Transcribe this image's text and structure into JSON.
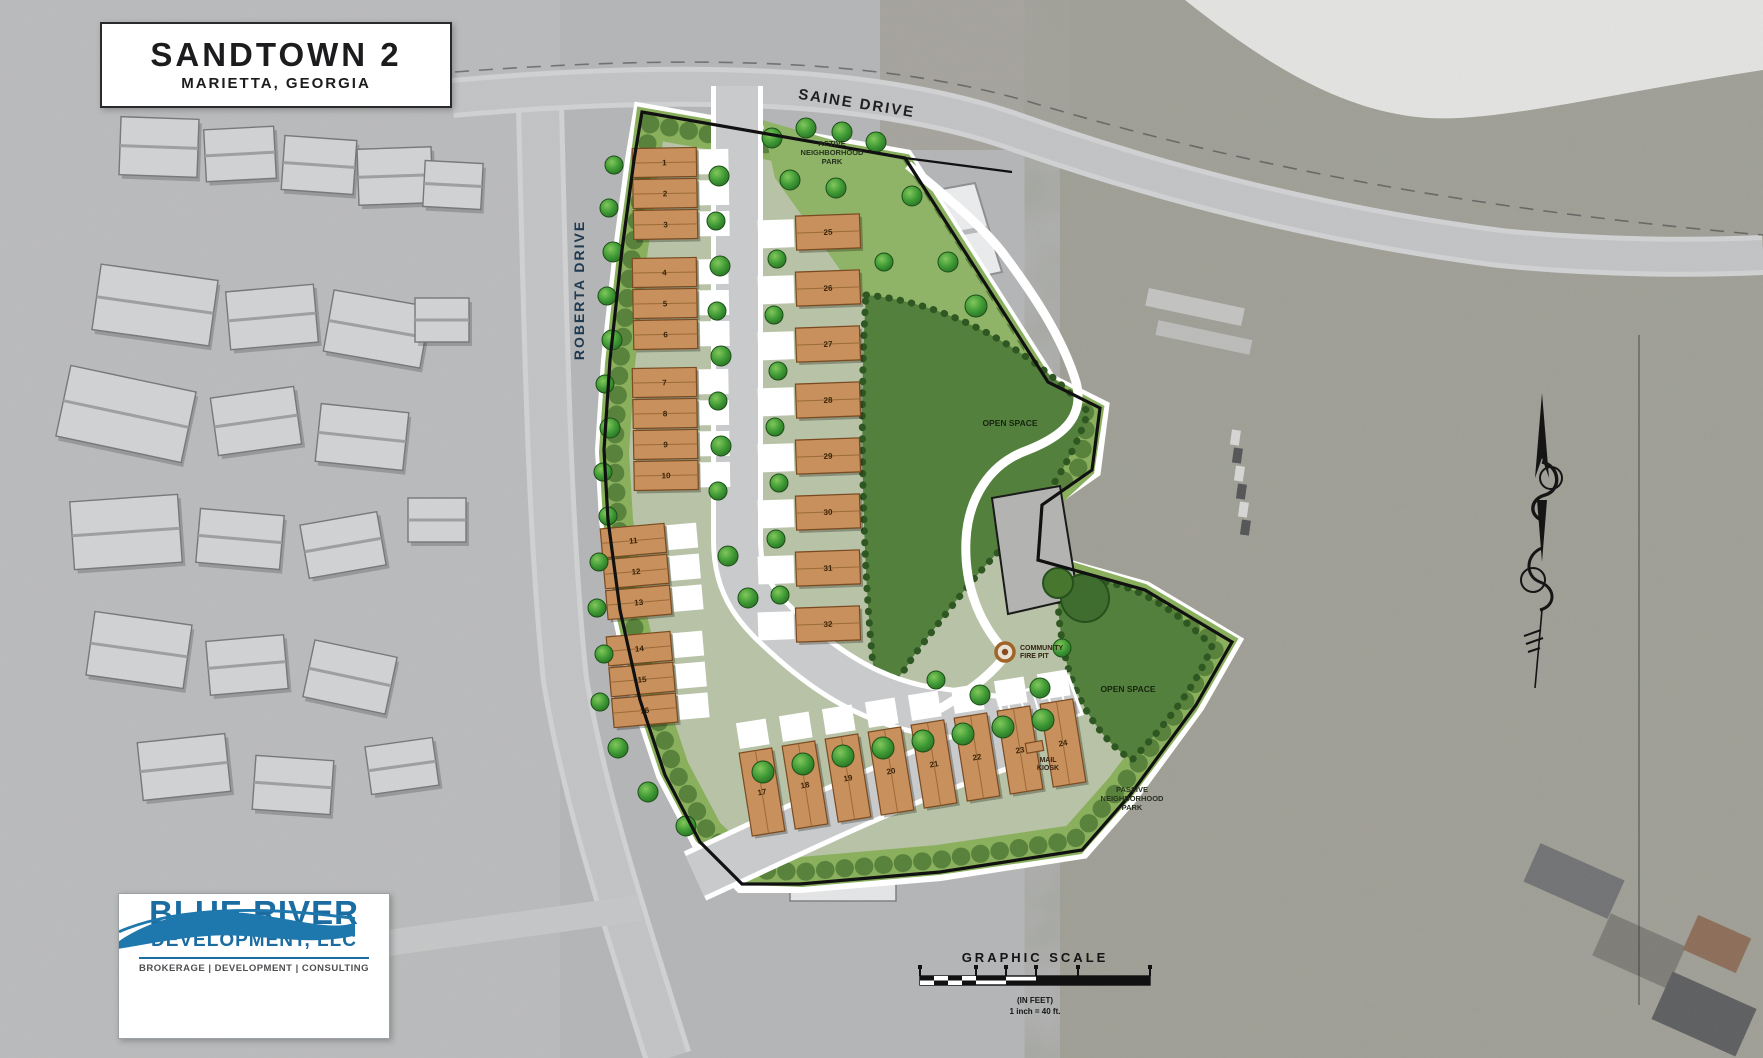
{
  "title_block": {
    "title": "SANDTOWN 2",
    "subtitle": "MARIETTA, GEORGIA"
  },
  "roads": {
    "saine": "SAINE DRIVE",
    "roberta": "ROBERTA DRIVE"
  },
  "site_labels": {
    "active_park": [
      "ACTIVE",
      "NEIGHBORHOOD",
      "PARK"
    ],
    "open_space_upper": "OPEN SPACE",
    "open_space_lower": "OPEN SPACE",
    "passive_park": [
      "PASSIVE",
      "NEIGHBORHOOD",
      "PARK"
    ],
    "fire_pit": [
      "COMMUNITY",
      "FIRE PIT"
    ],
    "mail_kiosk": [
      "MAIL",
      "KIOSK"
    ]
  },
  "scale": {
    "title": "GRAPHIC SCALE",
    "units": "(IN FEET)",
    "ratio": "1 inch = 40 ft."
  },
  "logo": {
    "name": "BLUE RIVER",
    "suffix": "DEVELOPMENT, LLC",
    "tagline": "BROKERAGE | DEVELOPMENT | CONSULTING"
  },
  "buildings": {
    "left_upper": [
      {
        "units": [
          "1",
          "2",
          "3"
        ]
      },
      {
        "units": [
          "4",
          "5",
          "6"
        ]
      },
      {
        "units": [
          "7",
          "8",
          "9",
          "10"
        ]
      }
    ],
    "left_lower": [
      {
        "units": [
          "11",
          "12",
          "13"
        ]
      },
      {
        "units": [
          "14",
          "15",
          "16"
        ]
      }
    ],
    "bottom_row": {
      "units": [
        "17",
        "18",
        "19",
        "20",
        "21",
        "22",
        "23",
        "24"
      ]
    },
    "center_column": {
      "units": [
        "25",
        "26",
        "27",
        "28",
        "29",
        "30",
        "31",
        "32"
      ]
    }
  },
  "colors": {
    "building_tan": "#c8905c",
    "site_green": "#8ab05e",
    "open_space_green": "#54803e",
    "road_gray": "#c9cacb",
    "logo_blue": "#1b6da1",
    "boundary": "#111111"
  }
}
